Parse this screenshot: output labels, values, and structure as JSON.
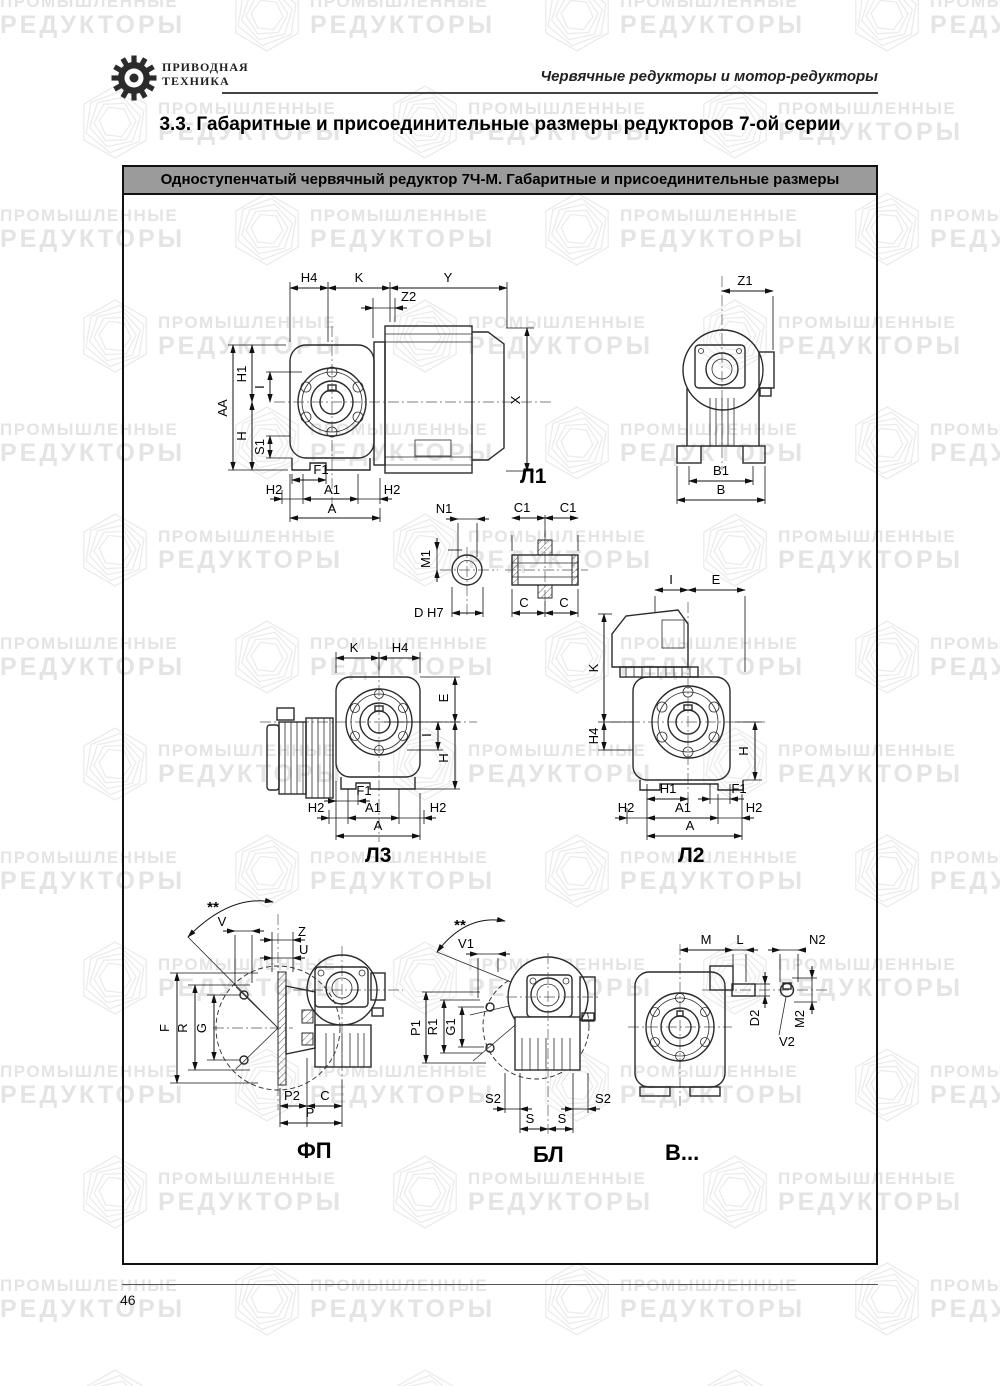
{
  "header": {
    "logo_line1": "ПРИВОДНАЯ",
    "logo_line2": "ТЕХНИКА",
    "tagline": "Червячные редукторы и мотор-редукторы"
  },
  "title": "3.3. Габаритные и присоединительные размеры редукторов 7-ой серии",
  "banner": "Одноступенчатый червячный редуктор 7Ч-М. Габаритные и присоединительные размеры",
  "page_number": "46",
  "watermark": {
    "line1": "ПРОМЫШЛЕННЫЕ",
    "line2": "РЕДУКТОРЫ"
  },
  "colors": {
    "banner_bg": "#9b9b9b",
    "line": "#2a2a2a",
    "watermark": "#e4e4e4"
  },
  "drawings": {
    "l1": {
      "caption": "Л1",
      "h4": "H4",
      "k": "K",
      "y": "Y",
      "z2": "Z2",
      "x": "X",
      "aa": "AA",
      "h1": "H1",
      "i": "I",
      "h": "H",
      "s1": "S1",
      "f1": "F1",
      "h2_left": "H2",
      "a1": "A1",
      "h2_right": "H2",
      "a": "A"
    },
    "rear": {
      "z1": "Z1",
      "b1": "B1",
      "b": "B"
    },
    "shaft_end": {
      "n1": "N1",
      "m1": "M1",
      "d": "D H7"
    },
    "bushing": {
      "c1_left": "C1",
      "c1_right": "C1",
      "c_left": "C",
      "c_right": "C"
    },
    "l3": {
      "caption": "Л3",
      "k": "K",
      "h4": "H4",
      "e": "E",
      "i": "I",
      "h": "H",
      "f1": "F1",
      "h2_left": "H2",
      "a1": "A1",
      "h2_right": "H2",
      "a": "A"
    },
    "l2": {
      "caption": "Л2",
      "i": "I",
      "e": "E",
      "k": "K",
      "h4": "H4",
      "h": "H",
      "h1": "H1",
      "f1": "F1",
      "h2_left": "H2",
      "a1": "A1",
      "h2_right": "H2",
      "a": "A"
    },
    "fp": {
      "caption": "ФП",
      "stars": "**",
      "v": "V",
      "z": "Z",
      "u": "U",
      "f": "F",
      "r": "R",
      "g": "G",
      "p2": "P2",
      "c": "C",
      "p": "P"
    },
    "bl": {
      "caption": "БЛ",
      "stars": "**",
      "v1": "V1",
      "p1": "P1",
      "r1": "R1",
      "g1": "G1",
      "s2_left": "S2",
      "s2_right": "S2",
      "s_left": "S",
      "s_right": "S"
    },
    "v": {
      "caption": "В...",
      "m": "M",
      "l": "L",
      "n2": "N2",
      "d2": "D2",
      "m2": "M2",
      "v2": "V2"
    }
  }
}
